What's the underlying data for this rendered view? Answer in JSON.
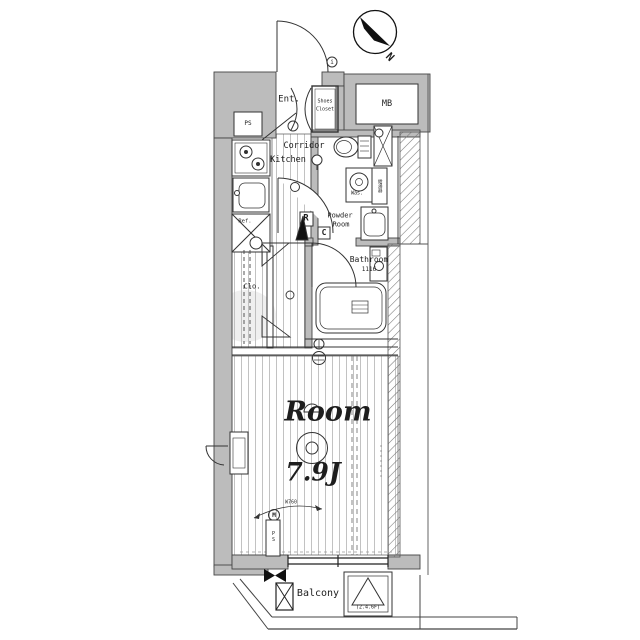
{
  "compass": {
    "north": "N"
  },
  "rooms": {
    "entrance": "Ent.",
    "shoes_closet_l1": "Shoes",
    "shoes_closet_l2": "Closet",
    "meter_box": "MB",
    "corridor": "Corridor",
    "kitchen": "Kitchen",
    "powder_room_l1": "Powder",
    "powder_room_l2": "Room",
    "bathroom": "Bathroom",
    "bathroom_size": "1116",
    "closet": "Clo.",
    "main_room": "Room",
    "main_room_size": "7.9J",
    "balcony": "Balcony",
    "evac_hatch_floors": "(2.4.6F)"
  },
  "fixtures": {
    "refrigerator": "Ref.",
    "washer": "Was.",
    "water_heater": "給湯器",
    "pipe_shaft_top": "PS",
    "pipe_shaft_bottom": "PS"
  },
  "symbols": {
    "meter": "M",
    "intercom": "i",
    "box_r": "R",
    "box_c": "C",
    "dimension_note": "W760"
  }
}
